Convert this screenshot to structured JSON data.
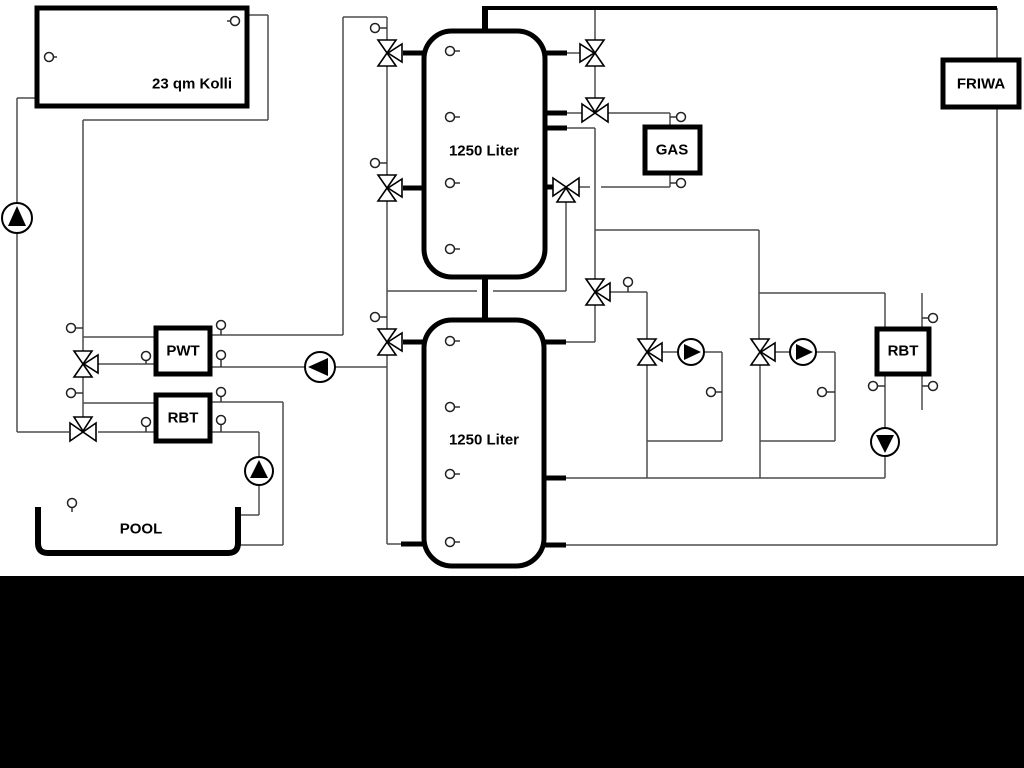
{
  "diagram": {
    "canvas": {
      "width": 1024,
      "height": 768,
      "background": "#ffffff"
    },
    "bottom_bar": {
      "y": 576,
      "height": 192,
      "color": "#000000"
    },
    "style": {
      "thin_color": "#4d4d4d",
      "thin_width": 1.5,
      "thick_color": "#000000",
      "symbol_stroke": "#000000",
      "symbol_fill": "#ffffff",
      "text_color": "#000000",
      "label_font_size": 15
    },
    "labels": {
      "collector": "23 qm Kolli",
      "tank_top": "1250 Liter",
      "tank_bottom": "1250 Liter",
      "gas": "GAS",
      "friwa": "FRIWA",
      "pwt": "PWT",
      "rbt_left": "RBT",
      "rbt_right": "RBT",
      "pool": "POOL"
    },
    "tanks": [
      {
        "name": "buffer-tank-top",
        "x": 424,
        "y": 31,
        "w": 121,
        "h": 246,
        "r": 28,
        "label": "1250 Liter",
        "label_x": 484,
        "label_y": 151
      },
      {
        "name": "buffer-tank-bottom",
        "x": 424,
        "y": 320,
        "w": 120,
        "h": 246,
        "r": 28,
        "label": "1250 Liter",
        "label_x": 484,
        "label_y": 440
      }
    ],
    "boxes": [
      {
        "name": "solar-collector-box",
        "x": 37,
        "y": 8,
        "w": 210,
        "h": 98,
        "label": "23 qm Kolli",
        "label_x": 192,
        "label_y": 84
      },
      {
        "name": "friwa-box",
        "x": 943,
        "y": 60,
        "w": 76,
        "h": 47,
        "label": "FRIWA",
        "label_x": 981,
        "label_y": 84
      },
      {
        "name": "gas-boiler-box",
        "x": 645,
        "y": 127,
        "w": 55,
        "h": 46,
        "label": "GAS",
        "label_x": 672,
        "label_y": 150
      },
      {
        "name": "pwt-box",
        "x": 156,
        "y": 328,
        "w": 54,
        "h": 46,
        "label": "PWT",
        "label_x": 183,
        "label_y": 351
      },
      {
        "name": "rbt-left-box",
        "x": 156,
        "y": 395,
        "w": 54,
        "h": 46,
        "label": "RBT",
        "label_x": 183,
        "label_y": 418
      },
      {
        "name": "rbt-right-box",
        "x": 877,
        "y": 329,
        "w": 52,
        "h": 45,
        "label": "RBT",
        "label_x": 903,
        "label_y": 351
      }
    ],
    "pool": {
      "name": "pool-basin",
      "path": "M 38 507 L 38 543 Q 38 553 48 553 L 228 553 Q 238 553 238 543 L 238 507",
      "stroke_width": 6,
      "label": "POOL",
      "label_x": 141,
      "label_y": 529
    },
    "pipes_thin": [
      [
        17,
        98,
        38,
        98
      ],
      [
        17,
        98,
        17,
        203
      ],
      [
        17,
        233,
        17,
        432
      ],
      [
        17,
        432,
        69,
        432
      ],
      [
        247,
        15,
        268,
        15
      ],
      [
        268,
        15,
        268,
        120
      ],
      [
        83,
        120,
        268,
        120
      ],
      [
        83,
        120,
        83,
        351
      ],
      [
        83,
        377,
        83,
        419
      ],
      [
        83,
        337,
        156,
        337
      ],
      [
        98,
        364,
        156,
        364
      ],
      [
        83,
        403,
        156,
        403
      ],
      [
        98,
        432,
        156,
        432
      ],
      [
        210,
        335,
        343,
        335
      ],
      [
        343,
        17,
        343,
        335
      ],
      [
        343,
        17,
        387,
        17
      ],
      [
        210,
        367,
        305,
        367
      ],
      [
        335,
        367,
        387,
        367
      ],
      [
        210,
        402,
        283,
        402
      ],
      [
        283,
        402,
        283,
        545
      ],
      [
        240,
        545,
        283,
        545
      ],
      [
        210,
        432,
        259,
        432
      ],
      [
        259,
        432,
        259,
        457
      ],
      [
        259,
        485,
        259,
        515
      ],
      [
        240,
        515,
        259,
        515
      ],
      [
        387,
        17,
        387,
        40
      ],
      [
        387,
        66,
        387,
        175
      ],
      [
        387,
        201,
        387,
        329
      ],
      [
        387,
        355,
        387,
        544
      ],
      [
        387,
        544,
        404,
        544
      ],
      [
        387,
        291,
        477,
        291
      ],
      [
        493,
        291,
        566,
        291
      ],
      [
        566,
        202,
        566,
        291
      ],
      [
        595,
        10,
        595,
        40
      ],
      [
        567,
        53,
        580,
        53
      ],
      [
        595,
        66,
        595,
        100
      ],
      [
        567,
        113,
        582,
        113
      ],
      [
        608,
        113,
        670,
        113
      ],
      [
        670,
        113,
        670,
        128
      ],
      [
        567,
        128,
        595,
        128
      ],
      [
        595,
        128,
        595,
        279
      ],
      [
        670,
        172,
        670,
        187
      ],
      [
        601,
        187,
        670,
        187
      ],
      [
        579,
        187,
        590,
        187
      ],
      [
        595,
        230,
        759,
        230
      ],
      [
        759,
        230,
        759,
        293
      ],
      [
        759,
        293,
        885,
        293
      ],
      [
        759,
        293,
        759,
        339
      ],
      [
        610,
        292,
        647,
        292
      ],
      [
        647,
        292,
        647,
        339
      ],
      [
        595,
        305,
        595,
        342
      ],
      [
        566,
        342,
        595,
        342
      ],
      [
        662,
        352,
        678,
        352
      ],
      [
        704,
        352,
        722,
        352
      ],
      [
        722,
        352,
        722,
        441
      ],
      [
        647,
        441,
        722,
        441
      ],
      [
        647,
        365,
        647,
        478
      ],
      [
        775,
        352,
        790,
        352
      ],
      [
        816,
        352,
        835,
        352
      ],
      [
        835,
        352,
        835,
        441
      ],
      [
        760,
        441,
        835,
        441
      ],
      [
        760,
        365,
        760,
        478
      ],
      [
        566,
        478,
        885,
        478
      ],
      [
        885,
        456,
        885,
        478
      ],
      [
        885,
        293,
        885,
        329
      ],
      [
        885,
        374,
        885,
        428
      ],
      [
        922,
        293,
        922,
        410
      ],
      [
        997,
        8,
        997,
        60
      ],
      [
        997,
        107,
        997,
        545
      ],
      [
        566,
        545,
        997,
        545
      ]
    ],
    "pipes_thick": [
      [
        483,
        8,
        997,
        8,
        4
      ],
      [
        485,
        6,
        485,
        32,
        6
      ],
      [
        485,
        276,
        485,
        321,
        6
      ],
      [
        403,
        53,
        426,
        53,
        5
      ],
      [
        403,
        188,
        426,
        188,
        5
      ],
      [
        543,
        53,
        567,
        53,
        5
      ],
      [
        543,
        113,
        567,
        113,
        5
      ],
      [
        543,
        128,
        567,
        128,
        5
      ],
      [
        543,
        187,
        554,
        187,
        5
      ],
      [
        403,
        342,
        426,
        342,
        5
      ],
      [
        401,
        544,
        426,
        544,
        5
      ],
      [
        543,
        342,
        566,
        342,
        5
      ],
      [
        543,
        478,
        566,
        478,
        5
      ],
      [
        543,
        545,
        566,
        545,
        5
      ]
    ],
    "valves": [
      {
        "name": "valve-solar-tank-top",
        "x": 387,
        "y": 53,
        "axis": "v",
        "branch": "right"
      },
      {
        "name": "valve-solar-tank-mid",
        "x": 387,
        "y": 188,
        "axis": "v",
        "branch": "right"
      },
      {
        "name": "valve-tank-bottom-left",
        "x": 387,
        "y": 342,
        "axis": "v",
        "branch": "right"
      },
      {
        "name": "valve-pwt-feed",
        "x": 83,
        "y": 364,
        "axis": "v",
        "branch": "right"
      },
      {
        "name": "valve-rbt-feed",
        "x": 83,
        "y": 432,
        "axis": "h",
        "branch": "top"
      },
      {
        "name": "valve-tank-top-right",
        "x": 595,
        "y": 53,
        "axis": "v",
        "branch": "left"
      },
      {
        "name": "valve-gas-supply",
        "x": 595,
        "y": 113,
        "axis": "h",
        "branch": "top"
      },
      {
        "name": "valve-gas-return",
        "x": 566,
        "y": 187,
        "axis": "h",
        "branch": "bottom"
      },
      {
        "name": "valve-distribution",
        "x": 595,
        "y": 292,
        "axis": "v",
        "branch": "right"
      },
      {
        "name": "valve-heating-loop-1",
        "x": 647,
        "y": 352,
        "axis": "v",
        "branch": "right"
      },
      {
        "name": "valve-heating-loop-2",
        "x": 760,
        "y": 352,
        "axis": "v",
        "branch": "right"
      }
    ],
    "pumps": [
      {
        "name": "solar-pump",
        "x": 17,
        "y": 218,
        "dir": "up",
        "r": 15
      },
      {
        "name": "pwt-pump",
        "x": 320,
        "y": 367,
        "dir": "left",
        "r": 15
      },
      {
        "name": "heating-pump-1",
        "x": 691,
        "y": 352,
        "dir": "right",
        "r": 13
      },
      {
        "name": "heating-pump-2",
        "x": 803,
        "y": 352,
        "dir": "right",
        "r": 13
      },
      {
        "name": "rbt-right-pump",
        "x": 885,
        "y": 442,
        "dir": "down",
        "r": 14
      },
      {
        "name": "pool-pump",
        "x": 259,
        "y": 471,
        "dir": "up",
        "r": 14
      }
    ],
    "sensors": [
      {
        "x": 49,
        "y": 57,
        "stem": "right",
        "len": 8
      },
      {
        "x": 235,
        "y": 21,
        "stem": "left",
        "len": 8
      },
      {
        "x": 375,
        "y": 28,
        "stem": "right",
        "len": 12
      },
      {
        "x": 375,
        "y": 163,
        "stem": "right",
        "len": 12
      },
      {
        "x": 375,
        "y": 317,
        "stem": "right",
        "len": 12
      },
      {
        "x": 71,
        "y": 328,
        "stem": "right",
        "len": 12
      },
      {
        "x": 71,
        "y": 393,
        "stem": "right",
        "len": 12
      },
      {
        "x": 146,
        "y": 356,
        "stem": "down",
        "len": 8
      },
      {
        "x": 146,
        "y": 422,
        "stem": "down",
        "len": 10
      },
      {
        "x": 221,
        "y": 325,
        "stem": "down",
        "len": 10
      },
      {
        "x": 221,
        "y": 355,
        "stem": "down",
        "len": 12
      },
      {
        "x": 221,
        "y": 392,
        "stem": "down",
        "len": 10
      },
      {
        "x": 221,
        "y": 420,
        "stem": "down",
        "len": 12
      },
      {
        "x": 450,
        "y": 51,
        "stem": "right",
        "len": 10
      },
      {
        "x": 450,
        "y": 117,
        "stem": "right",
        "len": 10
      },
      {
        "x": 450,
        "y": 183,
        "stem": "right",
        "len": 10
      },
      {
        "x": 450,
        "y": 249,
        "stem": "right",
        "len": 10
      },
      {
        "x": 450,
        "y": 341,
        "stem": "right",
        "len": 10
      },
      {
        "x": 450,
        "y": 407,
        "stem": "right",
        "len": 10
      },
      {
        "x": 450,
        "y": 474,
        "stem": "right",
        "len": 10
      },
      {
        "x": 450,
        "y": 542,
        "stem": "right",
        "len": 10
      },
      {
        "x": 681,
        "y": 117,
        "stem": "left",
        "len": 11
      },
      {
        "x": 681,
        "y": 183,
        "stem": "left",
        "len": 11
      },
      {
        "x": 628,
        "y": 282,
        "stem": "down",
        "len": 10
      },
      {
        "x": 711,
        "y": 392,
        "stem": "right",
        "len": 11
      },
      {
        "x": 822,
        "y": 392,
        "stem": "right",
        "len": 13
      },
      {
        "x": 873,
        "y": 386,
        "stem": "right",
        "len": 12
      },
      {
        "x": 933,
        "y": 318,
        "stem": "left",
        "len": 11
      },
      {
        "x": 933,
        "y": 386,
        "stem": "left",
        "len": 11
      },
      {
        "x": 72,
        "y": 503,
        "stem": "down",
        "len": 9
      }
    ]
  }
}
